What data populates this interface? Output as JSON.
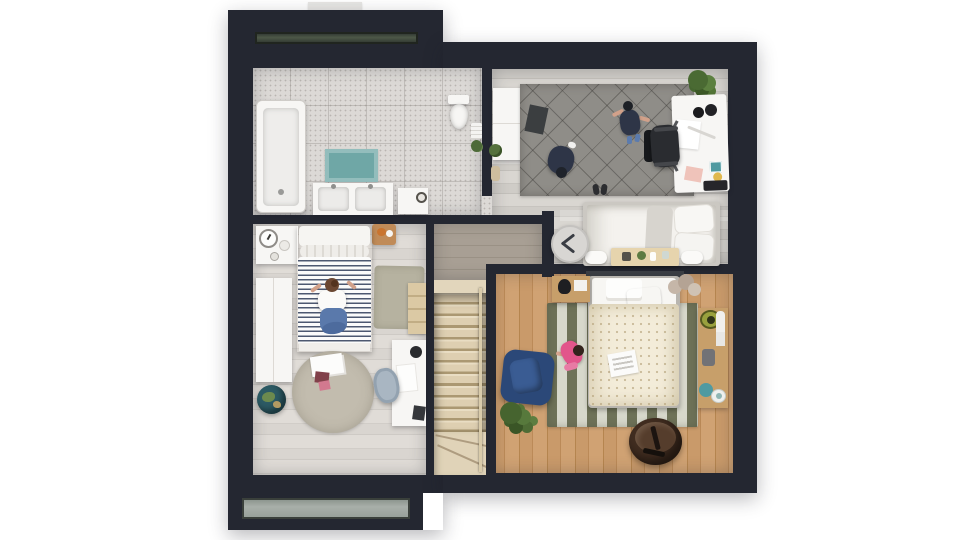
{
  "scene": {
    "type": "3d-floor-plan-top-down-render",
    "description": "upper floor plan with dark roof frame, two skylights and a chimney",
    "rooms": [
      {
        "name": "bathroom",
        "items": [
          "bathtub",
          "bath-mat",
          "double-sink-vanity",
          "storage-cabinet",
          "toilet",
          "towel-stack",
          "wall-plant"
        ]
      },
      {
        "name": "office-guest-room",
        "items": [
          "sideboard",
          "small-plant",
          "diamond-pattern-rug",
          "floor-mat",
          "person-kneeling",
          "person-standing",
          "shoes",
          "large-plant",
          "desk",
          "headphones",
          "papers",
          "pink-notepad",
          "laptop",
          "office-chair",
          "guest-bed",
          "foot-bench",
          "bolster-left",
          "bolster-right",
          "wall-clock"
        ]
      },
      {
        "name": "bedroom-left",
        "items": [
          "nightstand",
          "alarm-clock",
          "dish",
          "wood-tray",
          "striped-bed",
          "person-sitting",
          "sage-rug",
          "ladder-shelf",
          "wardrobe",
          "globe",
          "round-rug",
          "magazines",
          "desk",
          "desk-chair",
          "desk-lamp"
        ]
      },
      {
        "name": "bedroom-right",
        "items": [
          "striped-rug",
          "bed",
          "striped-pillow",
          "dotted-duvet",
          "magazine",
          "nightstand",
          "black-vase",
          "pampas-vase",
          "side-table",
          "green-bowl",
          "remote",
          "teal-cup",
          "white-bowl",
          "blue-armchair",
          "child-playing",
          "plant",
          "leather-pouf"
        ]
      },
      {
        "name": "landing",
        "items": []
      },
      {
        "name": "staircase",
        "items": [
          "stairs",
          "winder-steps",
          "railing"
        ]
      }
    ]
  },
  "palette": {
    "bg": "#ffffff",
    "wall_dark": "#242731",
    "chimney": "#e7e6e4",
    "bath_floor": "#dcd9d6",
    "furn_white": "#f7f6f4",
    "teal_mat": "#6fa7a6",
    "rug_gray": "#8f8d88",
    "rug_olive": "#6e7258",
    "rug_cream": "#d7d8cb",
    "rug_round": "#c2bcae",
    "rug_sage": "#b6b2a0",
    "stripe_navy": "#4d5870",
    "duvet_cream": "#f3ecd9",
    "wood_tan": "#c79f6a",
    "stair_beige": "#e2d6bc",
    "armchair_navy": "#2b4878",
    "pouf_brown": "#412d20",
    "plant_green": "#4d6a38",
    "person_navy": "#2e3547",
    "skin": "#d2a18a",
    "hair_brown": "#6b4732",
    "jeans_blue": "#5a79ab",
    "pink_dress": "#e2558b",
    "clock_gray": "#d8d6d3",
    "frame_gray": "#cbc8c2",
    "bench_wood": "#e6d4ad",
    "green_bowl": "#99a13e",
    "teal_accent": "#4f9aa1",
    "pink_pad": "#efc3ba",
    "landing_floor": "#a59c90"
  }
}
